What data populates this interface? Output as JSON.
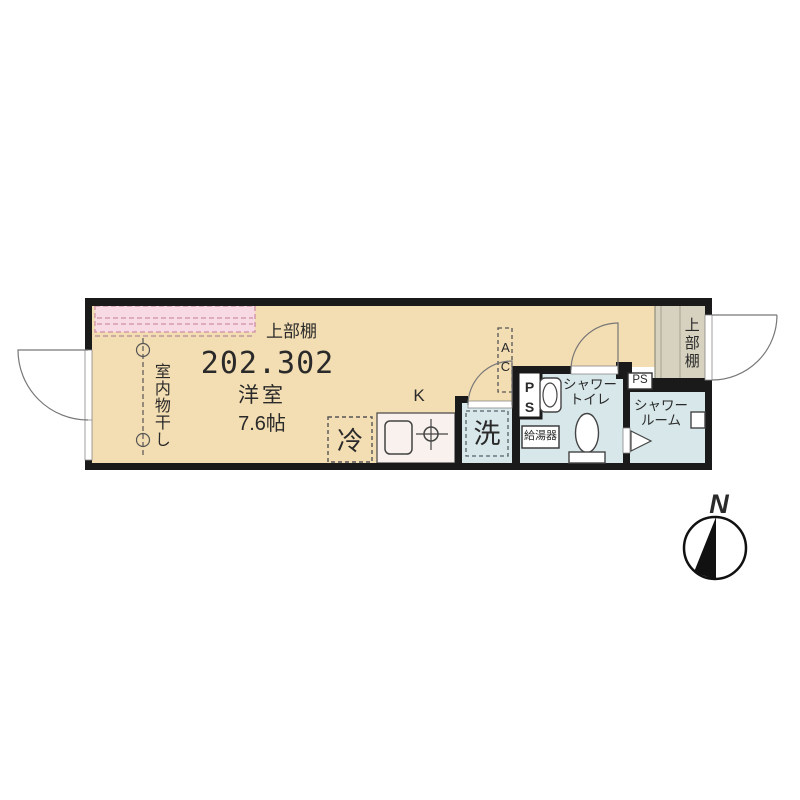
{
  "floor_plan": {
    "unit_number": "202.302",
    "main_room": {
      "type_label": "洋室",
      "size_label": "7.6帖"
    },
    "labels": {
      "upper_shelf_main": "上部棚",
      "upper_shelf_entrance": "上部棚",
      "indoor_laundry": "室内物干し",
      "kitchen": "K",
      "refrigerator": "冷",
      "washing_machine": "洗",
      "air_conditioner": "AC",
      "pipe_space": "PS",
      "pipe_space_small": "PS",
      "water_heater": "給湯器",
      "shower_toilet": "シャワー\nトイレ",
      "shower_room": "シャワー\nルーム"
    },
    "compass": {
      "north_label": "N"
    },
    "colors": {
      "wall": "#1a1a1a",
      "main_room_floor": "#f3ddb2",
      "wet_area_floor": "#d7e7ea",
      "entrance_floor": "#d6d2bf",
      "shelf_pink": "#f8dae4",
      "shelf_pink_dash": "#cf8fa8",
      "kitchen_counter": "#f8f1ee"
    }
  }
}
